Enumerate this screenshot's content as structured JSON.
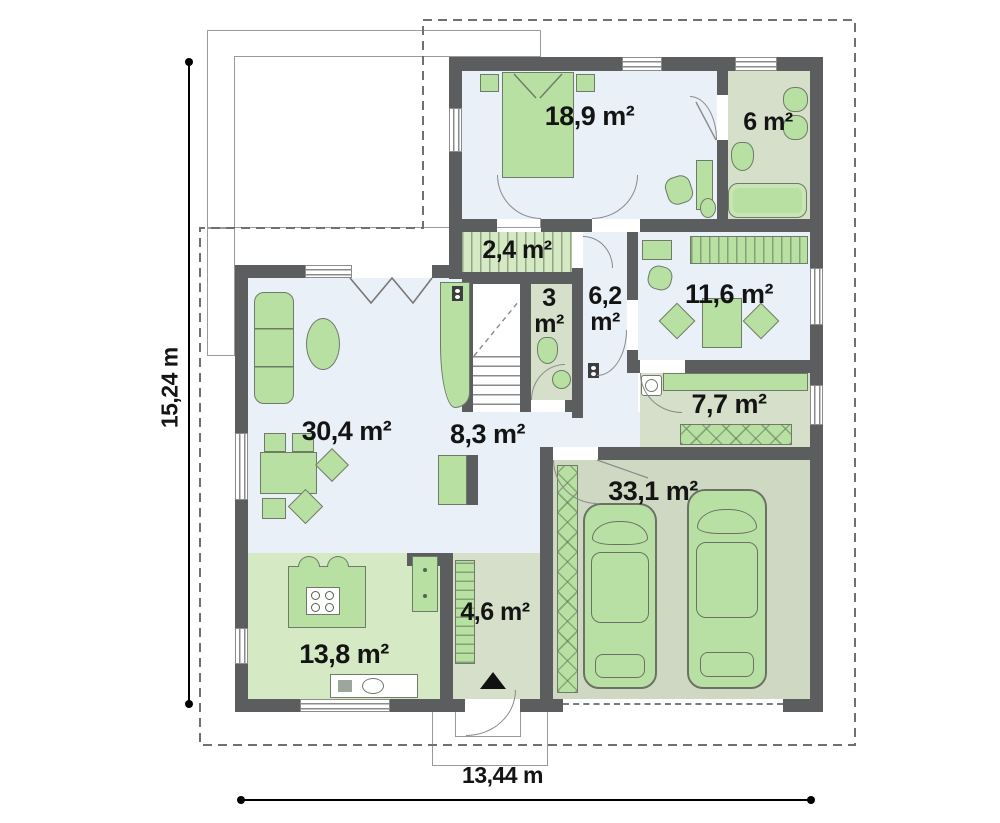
{
  "plan": {
    "rooms": [
      {
        "name": "bedroom",
        "area": "18,9 m²"
      },
      {
        "name": "bathroom",
        "area": "6 m²"
      },
      {
        "name": "closet",
        "area": "2,4 m²"
      },
      {
        "name": "wc",
        "area": "3 m²",
        "lines": [
          "3",
          "m²"
        ]
      },
      {
        "name": "hall-upper",
        "area": "6,2 m²",
        "lines": [
          "6,2",
          "m²"
        ]
      },
      {
        "name": "study",
        "area": "11,6 m²"
      },
      {
        "name": "utility",
        "area": "7,7 m²"
      },
      {
        "name": "living-room",
        "area": "30,4 m²"
      },
      {
        "name": "hallway",
        "area": "8,3 m²"
      },
      {
        "name": "garage",
        "area": "33,1 m²"
      },
      {
        "name": "entry",
        "area": "4,6 m²"
      },
      {
        "name": "kitchen",
        "area": "13,8 m²"
      }
    ],
    "overall_dimensions": {
      "height_label": "15,24 m",
      "width_label": "13,44 m"
    },
    "colors": {
      "wall": "#5c5d5f",
      "floor_light": "#eaf0f7",
      "floor_green": "#d5e9c4",
      "floor_sage": "#d6dfca",
      "floor_garage": "#cfd8c2",
      "furniture_green": "#b7e0a2",
      "dash_outline": "#707070",
      "text": "#141414"
    }
  }
}
